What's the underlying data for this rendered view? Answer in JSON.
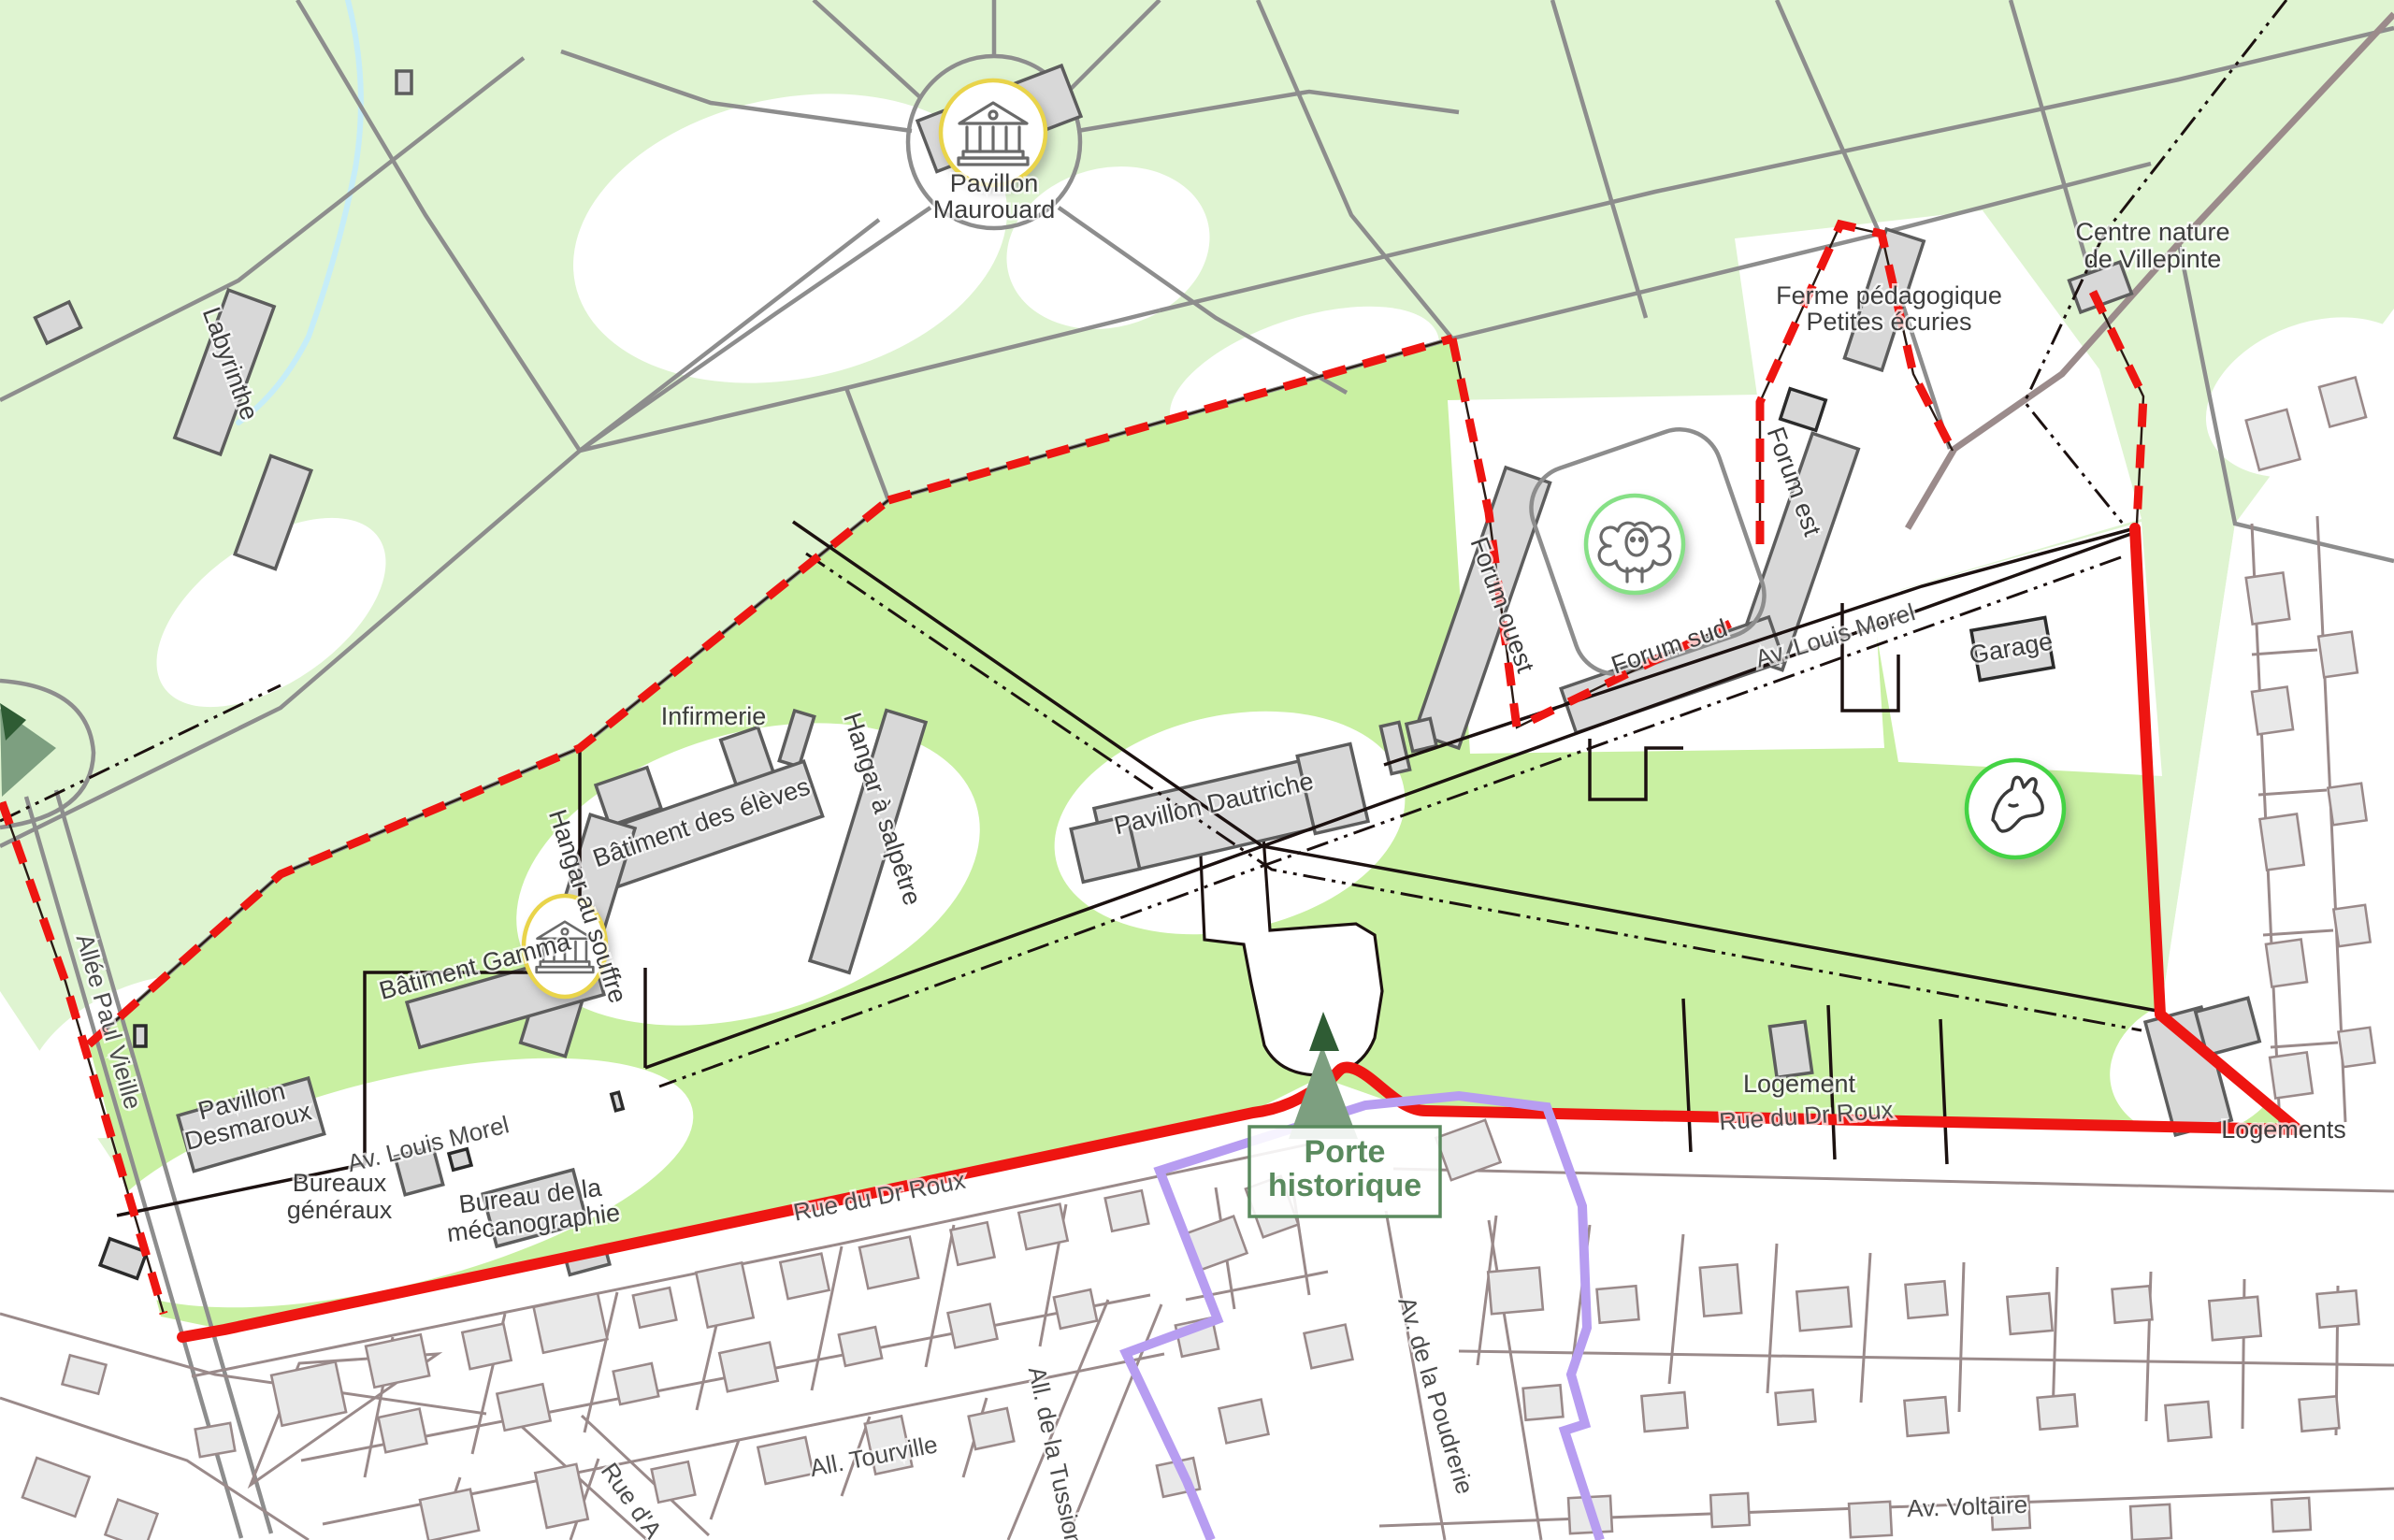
{
  "map": {
    "place_labels": {
      "pavillon_maurouard": [
        "Pavillon",
        "Maurouard"
      ],
      "labyrinthe": [
        "Labyrinthe"
      ],
      "centre_nature": [
        "Centre nature",
        "de Villepinte"
      ],
      "ferme_pedagogique": [
        "Ferme pédagogique",
        "Petites écuries"
      ],
      "forum_ouest": [
        "Forum ouest"
      ],
      "forum_est": [
        "Forum est"
      ],
      "forum_sud": [
        "Forum sud"
      ],
      "garage": [
        "Garage"
      ],
      "infirmerie": [
        "Infirmerie"
      ],
      "hangar_salpetre": [
        "Hangar à salpêtre"
      ],
      "batiment_eleves": [
        "Bâtiment des élèves"
      ],
      "hangar_souffre": [
        "Hangar au souffre"
      ],
      "batiment_gamma": [
        "Bâtiment Gamma"
      ],
      "pavillon_dautriche": [
        "Pavillon Dautriche"
      ],
      "pavillon_desmaroux": [
        "Pavillon",
        "Desmaroux"
      ],
      "bureaux_generaux": [
        "Bureaux",
        "généraux"
      ],
      "bureau_mecanographie": [
        "Bureau de la",
        "mécanographie"
      ],
      "logement": [
        "Logement"
      ],
      "logements": [
        "Logements"
      ],
      "porte_historique": [
        "Porte",
        "historique"
      ]
    },
    "street_labels": {
      "av_louis_morel_est": "Av. Louis Morel",
      "av_louis_morel_ouest": "Av. Louis Morel",
      "allee_paul_vieille": "Allée Paul Vieille",
      "rue_du_dr_roux_ouest": "Rue du Dr Roux",
      "rue_du_dr_roux_est": "Rue du Dr Roux",
      "all_tourville": "All. Tourville",
      "all_de_la_tussion": "All. de la Tussion",
      "rue_d_a": "Rue d'A",
      "av_de_la_poudrerie": "Av. de la Poudrerie",
      "av_voltaire": "Av. Voltaire"
    },
    "markers": {
      "museum_maurouard": "museum-icon",
      "museum_gamma": "museum-icon",
      "sheep": "sheep-icon",
      "horse": "horse-icon",
      "tree_porte": "tree-marker",
      "tree_west": "tree-marker"
    },
    "colors": {
      "park_green": "#dff4d1",
      "site_green": "#c9f0a2",
      "water_blue": "#c6edf8",
      "building_fill": "#d8d8d8",
      "suburb_building_fill": "#e9e9e9",
      "parcel_line": "#9a8a8a",
      "path_gray": "#8d8d8d",
      "boundary_red": "#ee1511",
      "boundary_purple": "#b79df1",
      "boundary_black": "#1c1110",
      "marker_green": "#7d9f80",
      "icon_ring_yellow": "#e9d44a",
      "icon_ring_green": "#44d344",
      "label_text": "#3d3d3d",
      "porte_text_green": "#5a8a5e"
    }
  }
}
